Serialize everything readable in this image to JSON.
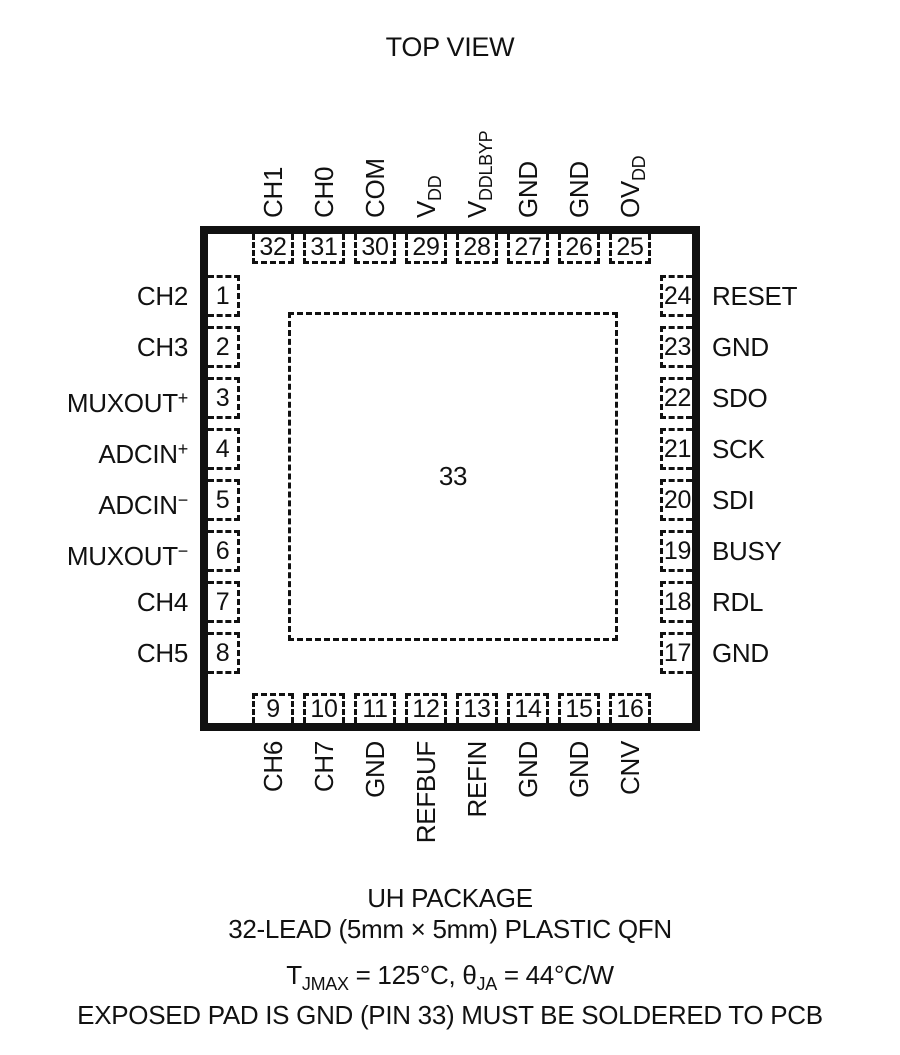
{
  "title": "TOP VIEW",
  "colors": {
    "ink": "#111111",
    "background": "#ffffff"
  },
  "package": {
    "center_pad_number": "33",
    "pins": {
      "top": [
        {
          "num": "32",
          "label": "CH1"
        },
        {
          "num": "31",
          "label": "CH0"
        },
        {
          "num": "30",
          "label": "COM"
        },
        {
          "num": "29",
          "label": "V",
          "sub": "DD"
        },
        {
          "num": "28",
          "label": "V",
          "sub": "DDLBYP"
        },
        {
          "num": "27",
          "label": "GND"
        },
        {
          "num": "26",
          "label": "GND"
        },
        {
          "num": "25",
          "label": "OV",
          "sub": "DD"
        }
      ],
      "bottom": [
        {
          "num": "9",
          "label": "CH6"
        },
        {
          "num": "10",
          "label": "CH7"
        },
        {
          "num": "11",
          "label": "GND"
        },
        {
          "num": "12",
          "label": "REFBUF"
        },
        {
          "num": "13",
          "label": "REFIN"
        },
        {
          "num": "14",
          "label": "GND"
        },
        {
          "num": "15",
          "label": "GND"
        },
        {
          "num": "16",
          "label": "CNV"
        }
      ],
      "left": [
        {
          "num": "1",
          "label": "CH2"
        },
        {
          "num": "2",
          "label": "CH3"
        },
        {
          "num": "3",
          "label": "MUXOUT",
          "sup": "+"
        },
        {
          "num": "4",
          "label": "ADCIN",
          "sup": "+"
        },
        {
          "num": "5",
          "label": "ADCIN",
          "sup": "−"
        },
        {
          "num": "6",
          "label": "MUXOUT",
          "sup": "−"
        },
        {
          "num": "7",
          "label": "CH4"
        },
        {
          "num": "8",
          "label": "CH5"
        }
      ],
      "right": [
        {
          "num": "24",
          "label": "RESET"
        },
        {
          "num": "23",
          "label": "GND"
        },
        {
          "num": "22",
          "label": "SDO"
        },
        {
          "num": "21",
          "label": "SCK"
        },
        {
          "num": "20",
          "label": "SDI"
        },
        {
          "num": "19",
          "label": "BUSY"
        },
        {
          "num": "18",
          "label": "RDL"
        },
        {
          "num": "17",
          "label": "GND"
        }
      ]
    }
  },
  "caption": {
    "line1": "UH PACKAGE",
    "line2": "32-LEAD (5mm × 5mm) PLASTIC QFN",
    "line3_parts": [
      {
        "text": "T"
      },
      {
        "sub": "JMAX"
      },
      {
        "text": " = 125°C, θ"
      },
      {
        "sub": "JA"
      },
      {
        "text": " = 44°C/W"
      }
    ],
    "line4": "EXPOSED PAD IS GND (PIN 33) MUST BE SOLDERED TO PCB"
  }
}
